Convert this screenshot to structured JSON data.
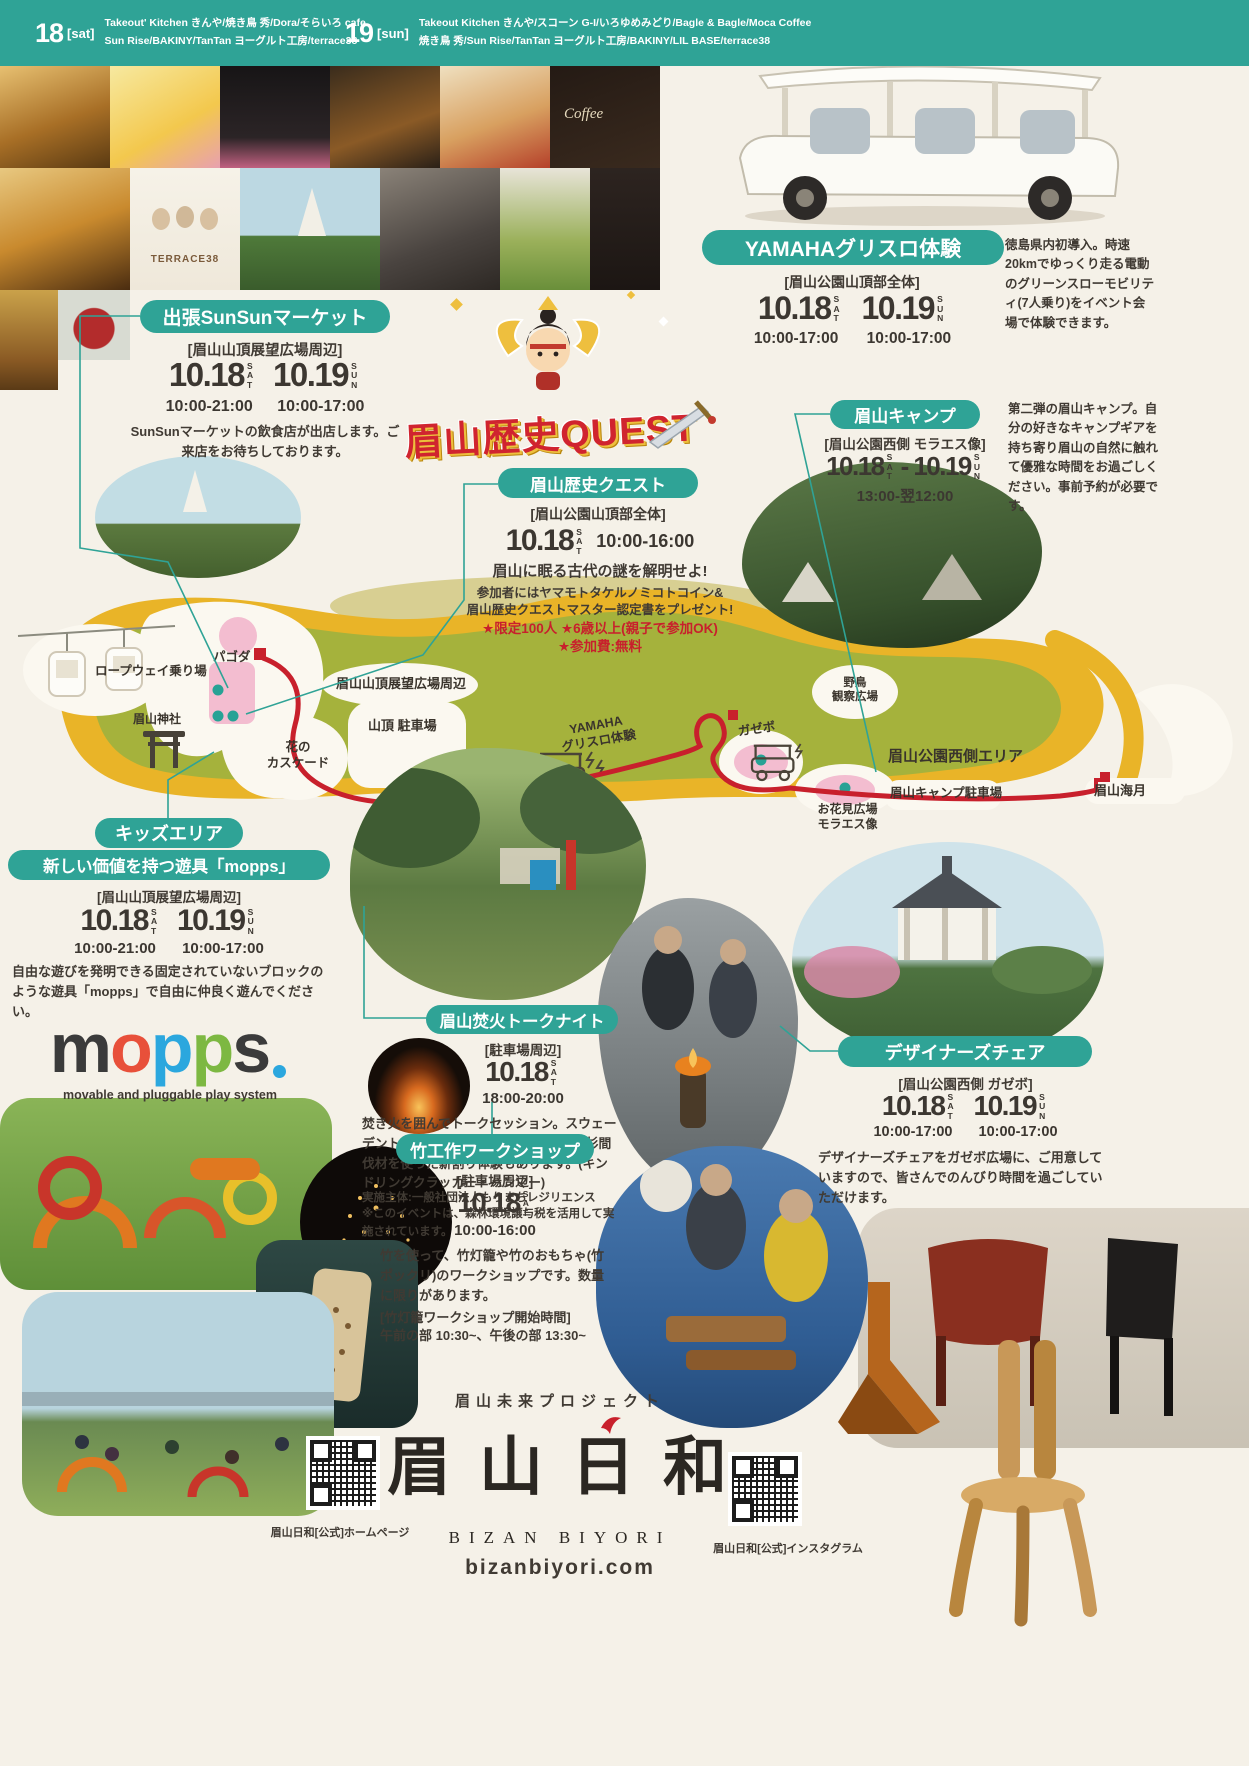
{
  "colors": {
    "teal": "#2fa396",
    "red": "#c8202c",
    "ink": "#403a33",
    "map_green": "#a5b23c",
    "map_yellow": "#e9b428",
    "map_pink": "#f3bdd0"
  },
  "header": {
    "d1_num": "18",
    "d1_tag": "[sat]",
    "d1_line1": "Takeout' Kitchen きんや/焼き鳥 秀/Dora/そらいろ cafe",
    "d1_line2": "Sun Rise/BAKINY/TanTan ヨーグルト工房/terrace38",
    "d2_num": "19",
    "d2_tag": "[sun]",
    "d2_line1": "Takeout Kitchen きんや/スコーン G-I/いろゆめみどり/Bagle & Bagle/Moca Coffee",
    "d2_line2": "焼き鳥 秀/Sun Rise/TanTan ヨーグルト工房/BAKINY/LIL BASE/terrace38"
  },
  "quest_logo": "眉山歴史QUEST",
  "photos": {
    "terrace_label": "TERRACE38",
    "coffee_label": "Coffee"
  },
  "sections": {
    "sunsun": {
      "title": "出張SunSunマーケット",
      "location": "[眉山山頂展望広場周辺]",
      "date1": "10.18",
      "day1": "SAT",
      "date2": "10.19",
      "day2": "SUN",
      "time1": "10:00-21:00",
      "time2": "10:00-17:00",
      "desc": "SunSunマーケットの飲食店が出店します。ご来店をお待ちしております。"
    },
    "quest": {
      "title": "眉山歴史クエスト",
      "location": "[眉山公園山頂部全体]",
      "date1": "10.18",
      "day1": "SAT",
      "time": "10:00-16:00",
      "lead": "眉山に眠る古代の謎を解明せよ!",
      "desc1": "参加者にはヤマモトタケルノミコトコイン&",
      "desc2": "眉山歴史クエストマスター認定書をプレゼント!",
      "note1": "★限定100人 ★6歳以上(親子で参加OK)",
      "note2": "★参加費:無料"
    },
    "yamaha": {
      "title": "YAMAHAグリスロ体験",
      "location": "[眉山公園山頂部全体]",
      "date1": "10.18",
      "day1": "SAT",
      "date2": "10.19",
      "day2": "SUN",
      "time1": "10:00-17:00",
      "time2": "10:00-17:00",
      "desc": "徳島県内初導入。時速20kmでゆっくり走る電動のグリーンスローモビリティ(7人乗り)をイベント会場で体験できます。"
    },
    "camp": {
      "title": "眉山キャンプ",
      "location": "[眉山公園西側 モラエス像]",
      "date1": "10.18",
      "day1": "SAT",
      "sep": "-",
      "date2": "10.19",
      "day2": "SUN",
      "time": "13:00-翌12:00",
      "desc": "第二弾の眉山キャンプ。自分の好きなキャンプギアを持ち寄り眉山の自然に触れて優雅な時間をお過ごしください。事前予約が必要です。"
    },
    "kids": {
      "title1": "キッズエリア",
      "title2": "新しい価値を持つ遊具「mopps」",
      "location": "[眉山山頂展望広場周辺]",
      "date1": "10.18",
      "day1": "SAT",
      "date2": "10.19",
      "day2": "SUN",
      "time1": "10:00-21:00",
      "time2": "10:00-17:00",
      "desc": "自由な遊びを発明できる固定されていないブロックのような遊具「mopps」で自由に仲良く遊んでください。",
      "logo_tagline": "movable and pluggable play system"
    },
    "bonfire": {
      "title": "眉山焚火トークナイト",
      "location": "[駐車場周辺]",
      "date1": "10.18",
      "day1": "SAT",
      "time": "18:00-20:00",
      "desc": "焚き火を囲んでトークセッション。スウェーデントーチ+焚火台で演出します。神山杉間伐材を使った薪割り体験もあります。(キンドリングクラッカー・ハンマー)",
      "note1": "実施主体:一般社団法人もりまちレジリエンス",
      "note2": "※このイベントは、森林環境譲与税を活用して実施されています。"
    },
    "bamboo": {
      "title": "竹工作ワークショップ",
      "location": "[駐車場周辺]",
      "date1": "10.18",
      "day1": "SAT",
      "time": "10:00-16:00",
      "desc": "竹を使って、竹灯籠や竹のおもちゃ(竹ポックリ)のワークショップです。数量に限りがあります。",
      "note1": "[竹灯籠ワークショップ開始時間]",
      "note2": "午前の部 10:30~、午後の部 13:30~"
    },
    "chair": {
      "title": "デザイナーズチェア",
      "location": "[眉山公園西側 ガゼボ]",
      "date1": "10.18",
      "day1": "SAT",
      "date2": "10.19",
      "day2": "SUN",
      "time1": "10:00-17:00",
      "time2": "10:00-17:00",
      "desc": "デザイナーズチェアをガゼボ広場に、ご用意していますので、皆さんでのんびり時間を過ごしていただけます。"
    }
  },
  "mopps_logo": {
    "letters": [
      "m",
      "o",
      "p",
      "p",
      "s"
    ],
    "colors": [
      "#3b3b3b",
      "#e8503a",
      "#2ba7de",
      "#7db842",
      "#3b3b3b"
    ],
    "dot_color": "#2ba7de"
  },
  "map": {
    "labels": {
      "ropeway": "ロープウェイ乗り場",
      "pagoda": "パゴダ",
      "summit_plaza": "眉山山頂展望広場周辺",
      "cascade": "花の\nカスケード",
      "parking": "山頂 駐車場",
      "shrine": "眉山神社",
      "yamaha": "YAMAHA\nグリスロ体験",
      "gazebo": "ガゼボ",
      "bird": "野鳥\n観察広場",
      "west_area": "眉山公園西側エリア",
      "camp_parking": "眉山キャンプ駐車場",
      "hanami": "お花見広場\nモラエス像",
      "kaigetsu": "眉山海月"
    }
  },
  "footer": {
    "project": "眉山未来プロジェクト",
    "logo": "眉 山 日 和",
    "logo_en": "BIZAN BIYORI",
    "url": "bizanbiyori.com",
    "qr_left_caption": "眉山日和[公式]ホームページ",
    "qr_right_caption": "眉山日和[公式]インスタグラム"
  }
}
